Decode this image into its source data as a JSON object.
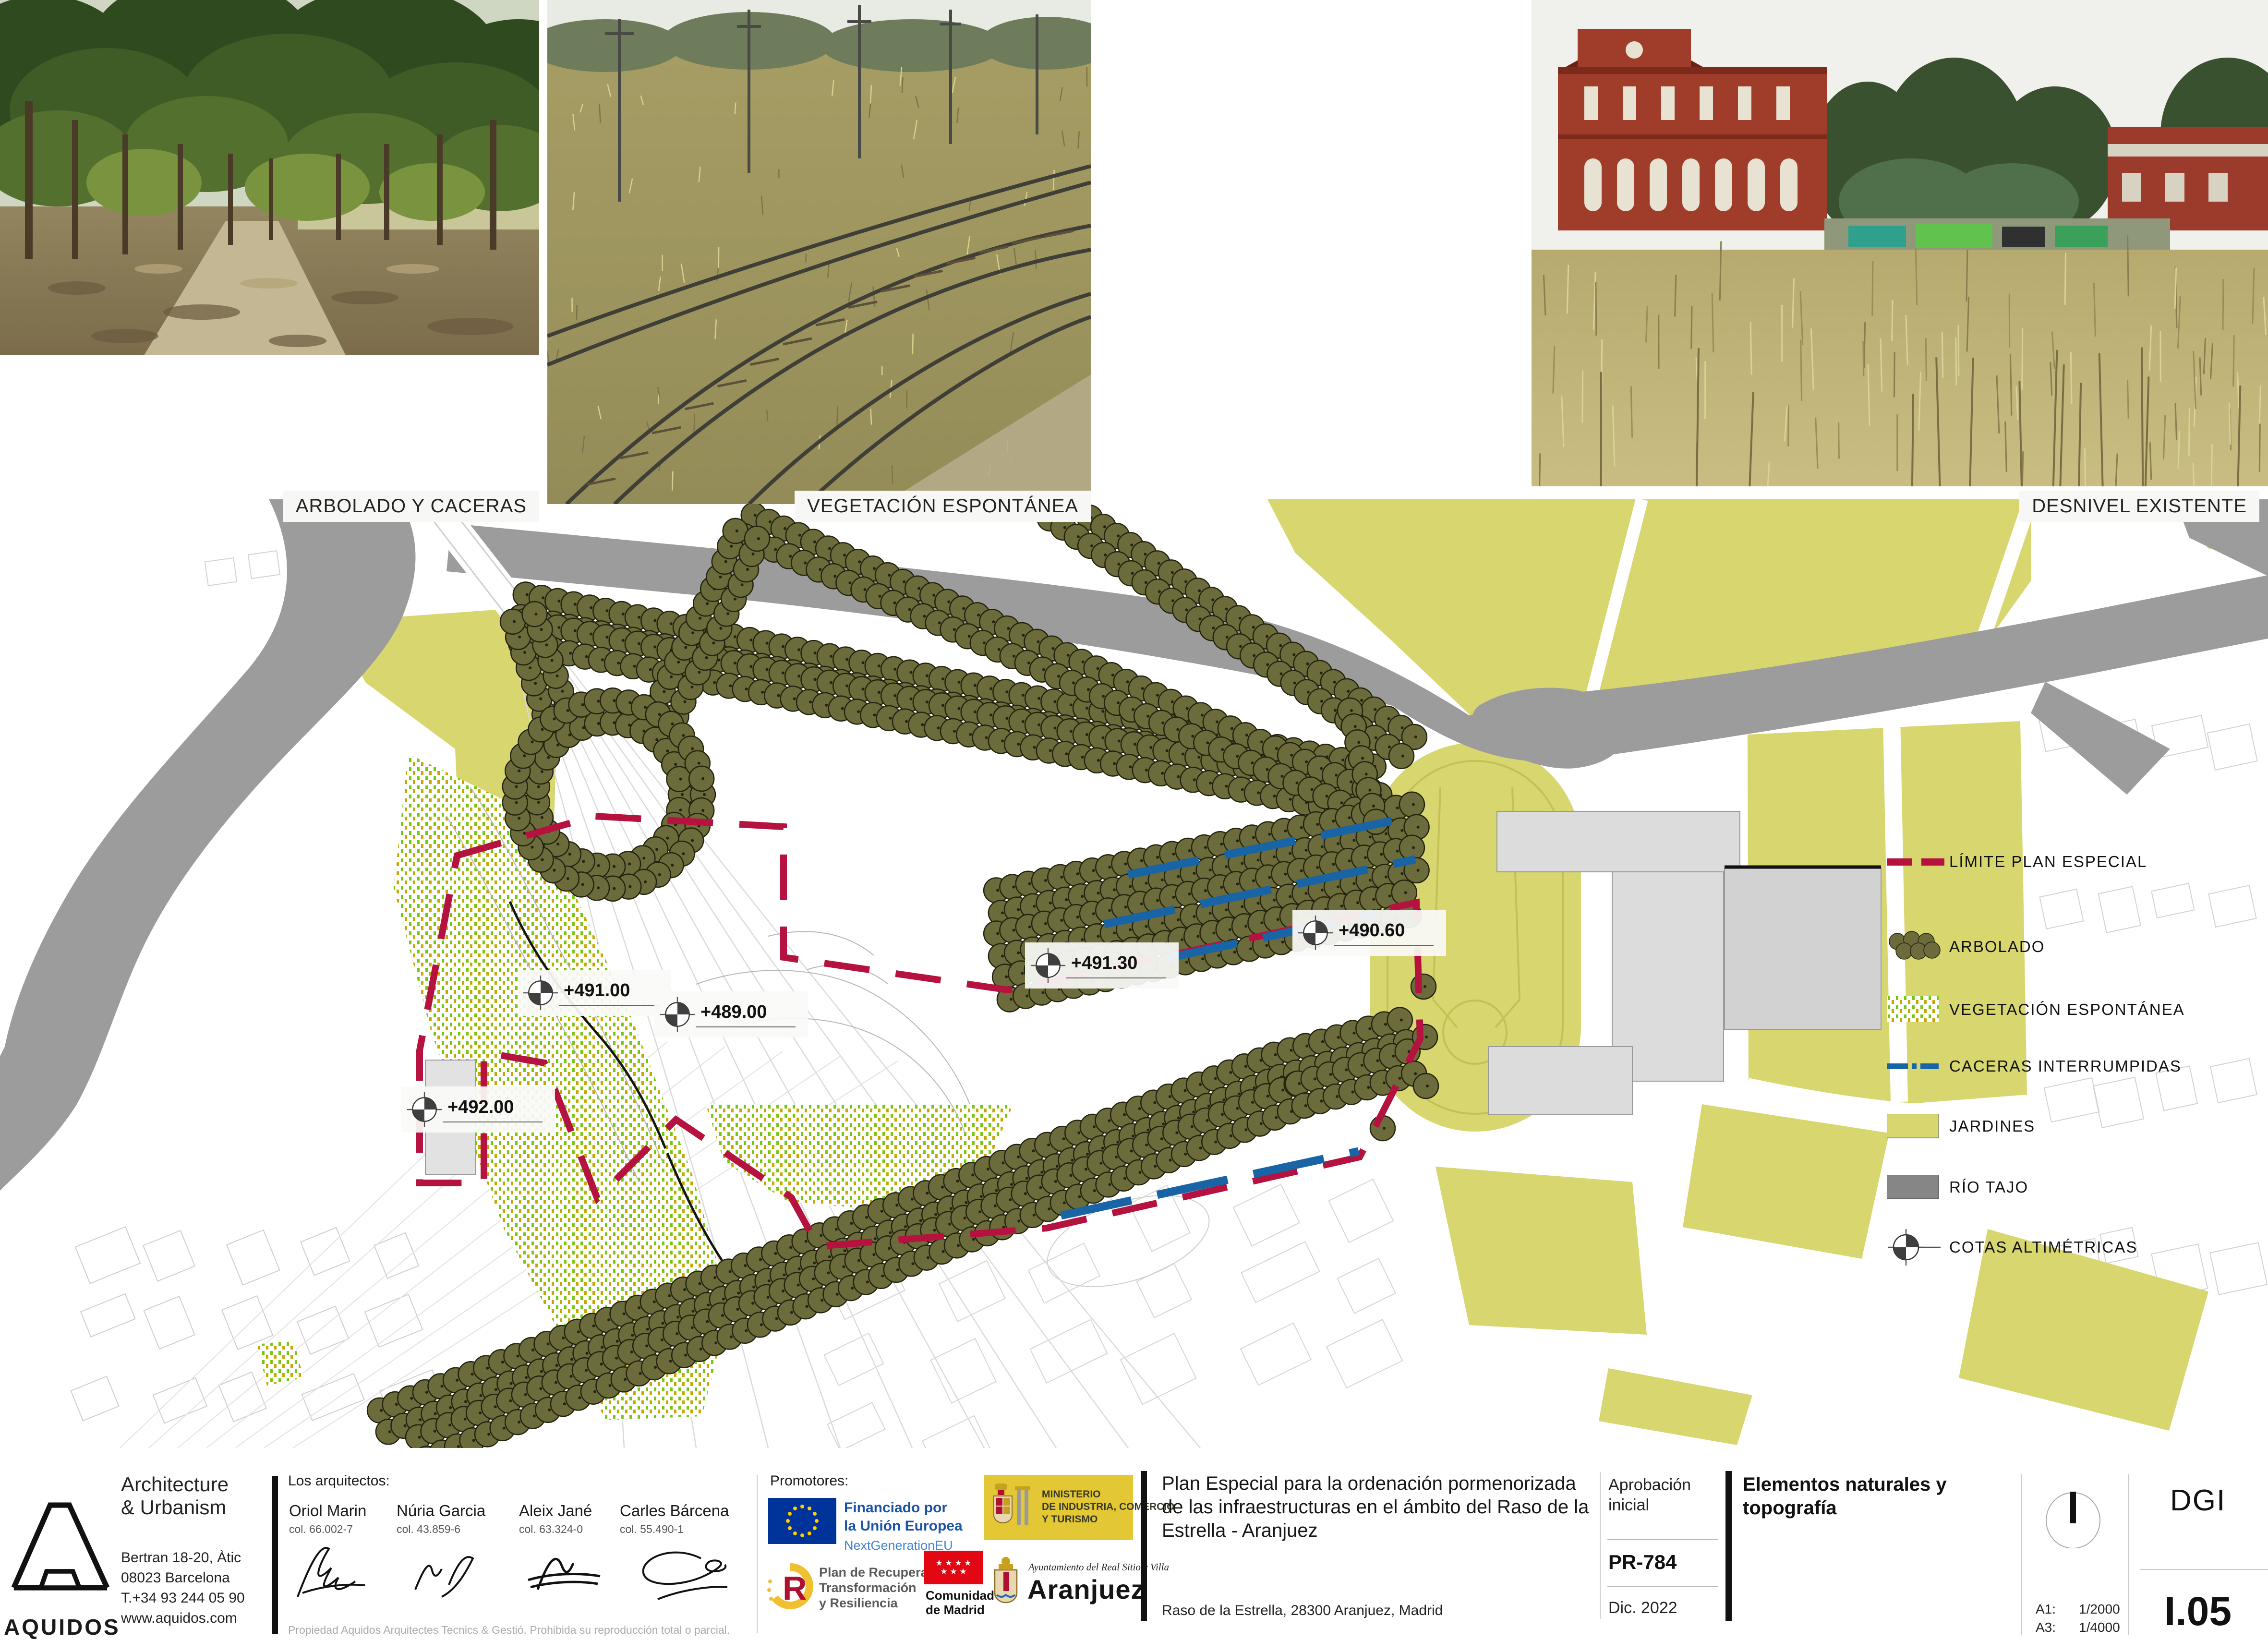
{
  "photos": {
    "captions": [
      "ARBOLADO Y CACERAS",
      "VEGETACIÓN ESPONTÁNEA",
      "DESNIVEL EXISTENTE"
    ]
  },
  "map": {
    "cotas": [
      {
        "label": "+491.00"
      },
      {
        "label": "+489.00"
      },
      {
        "label": "+491.30"
      },
      {
        "label": "+490.60"
      },
      {
        "label": "+492.00"
      }
    ]
  },
  "legend": {
    "items": [
      {
        "id": "limite",
        "label": "LÍMITE PLAN ESPECIAL"
      },
      {
        "id": "arbolado",
        "label": "ARBOLADO"
      },
      {
        "id": "vegetacion",
        "label": "VEGETACIÓN ESPONTÁNEA"
      },
      {
        "id": "caceras",
        "label": "CACERAS INTERRUMPIDAS"
      },
      {
        "id": "jardines",
        "label": "JARDINES"
      },
      {
        "id": "rio",
        "label": "RÍO TAJO"
      },
      {
        "id": "cotas",
        "label": "COTAS ALTIMÉTRICAS"
      }
    ]
  },
  "titleblock": {
    "firm": {
      "brand": "AQUIDOS",
      "tagline1": "Architecture",
      "tagline2": "& Urbanism",
      "address1": "Bertran 18-20, Àtic",
      "address2": "08023 Barcelona",
      "phone": "T.+34 93 244 05 90",
      "web": "www.aquidos.com"
    },
    "architects": {
      "heading": "Los arquitectos:",
      "list": [
        {
          "name": "Oriol Marin",
          "college": "col. 66.002-7"
        },
        {
          "name": "Núria Garcia",
          "college": "col. 43.859-6"
        },
        {
          "name": "Aleix Jané",
          "college": "col. 63.324-0"
        },
        {
          "name": "Carles Bárcena",
          "college": "col. 55.490-1"
        }
      ],
      "disclaimer": "Propiedad Aquidos Arquitectes Tecnics & Gestió. Prohibida su reproducción total o parcial."
    },
    "promoters": {
      "heading": "Promotores:",
      "eu_line1": "Financiado por",
      "eu_line2": "la Unión Europea",
      "eu_line3": "NextGenerationEU",
      "ministry_line1": "MINISTERIO",
      "ministry_line2": "DE INDUSTRIA, COMERCIO",
      "ministry_line3": "Y TURISMO",
      "plan_line1": "Plan de Recuperación,",
      "plan_line2": "Transformación",
      "plan_line3": "y Resiliencia",
      "madrid_line1": "Comunidad",
      "madrid_line2": "de Madrid",
      "aranjuez_small": "Ayuntamiento del Real Sitio y Villa",
      "aranjuez_big": "Aranjuez"
    },
    "project": {
      "title": "Plan Especial para la ordenación pormenorizada de las infraestructuras en el ámbito del Raso de la Estrella - Aranjuez",
      "address": "Raso de la Estrella, 28300 Aranjuez, Madrid"
    },
    "status": {
      "phase_line1": "Aprobación",
      "phase_line2": "inicial",
      "code": "PR-784",
      "date": "Dic. 2022"
    },
    "sheet": {
      "title": "Elementos naturales y topografía",
      "scales": [
        {
          "format": "A1:",
          "scale": "1/2000"
        },
        {
          "format": "A3:",
          "scale": "1/4000"
        }
      ],
      "series": "DGI",
      "number": "I.05"
    }
  },
  "colors": {
    "limite_red": "#b5123f",
    "caceras_blue": "#1864a5",
    "jardines_yellow": "#d8d66e",
    "rio_gray": "#9c9c9c",
    "arbolado_olive": "#6b6b3b",
    "vegetacion_green": "#76c80e",
    "vegetacion_gold": "#c8a800"
  }
}
